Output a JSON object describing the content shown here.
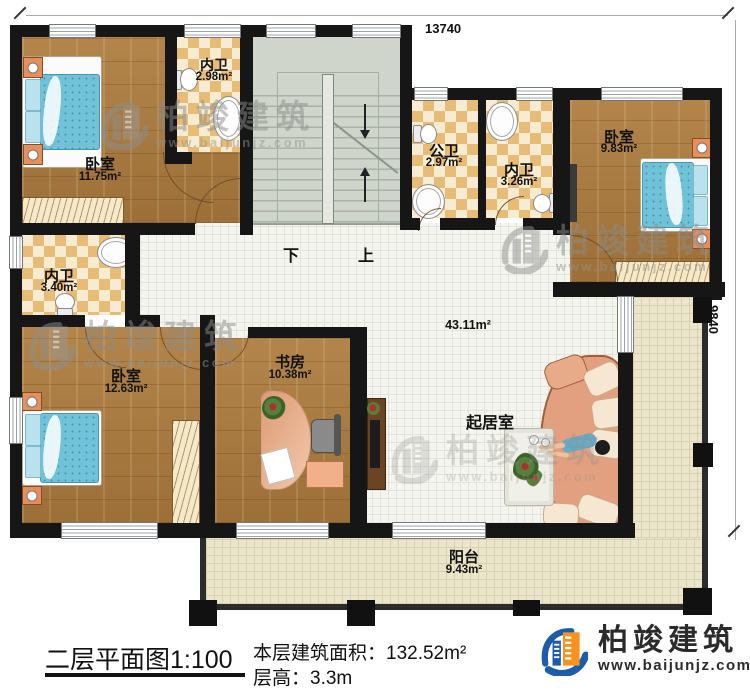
{
  "dimensions": {
    "top": "13740",
    "right": "9840"
  },
  "stairs": {
    "down_label": "下",
    "up_label": "上"
  },
  "rooms": {
    "bedroom1": {
      "name": "卧室",
      "area": "11.75m²"
    },
    "ensuite1": {
      "name": "内卫",
      "area": "2.98m²"
    },
    "public_bath": {
      "name": "公卫",
      "area": "2.97m²"
    },
    "ensuite2": {
      "name": "内卫",
      "area": "3.26m²"
    },
    "bedroom2": {
      "name": "卧室",
      "area": "9.83m²"
    },
    "ensuite3": {
      "name": "内卫",
      "area": "3.40m²"
    },
    "bedroom3": {
      "name": "卧室",
      "area": "12.63m²"
    },
    "study": {
      "name": "书房",
      "area": "10.38m²"
    },
    "living": {
      "name": "起居室",
      "hall_area": "43.11m²"
    },
    "balcony": {
      "name": "阳台",
      "area": "9.43m²"
    }
  },
  "title_block": {
    "plan_title": "二层平面图",
    "scale": "1:100",
    "area_label": "本层建筑面积：",
    "area_value": "132.52m²",
    "height_label": "层高：",
    "height_value": "3.3m"
  },
  "logo": {
    "name": "柏竣建筑",
    "website": "www.baijunjz.com"
  },
  "watermark": {
    "text": "柏竣建筑",
    "website": "www.baijunjz.com"
  },
  "colors": {
    "wall": "#161616",
    "wood": "#ad7c3e",
    "checker_dark": "#e7bc76",
    "checker_light": "#f7ecd2",
    "stair": "#cfd5ca",
    "hall_tile": "#f5f5f0",
    "balcony_tile": "#ebe5cb",
    "bed_blue": "#70c2d8",
    "sofa_salmon": "#e2a080",
    "logo_blue": "#1c5ca8",
    "logo_orange": "#f6921e"
  }
}
